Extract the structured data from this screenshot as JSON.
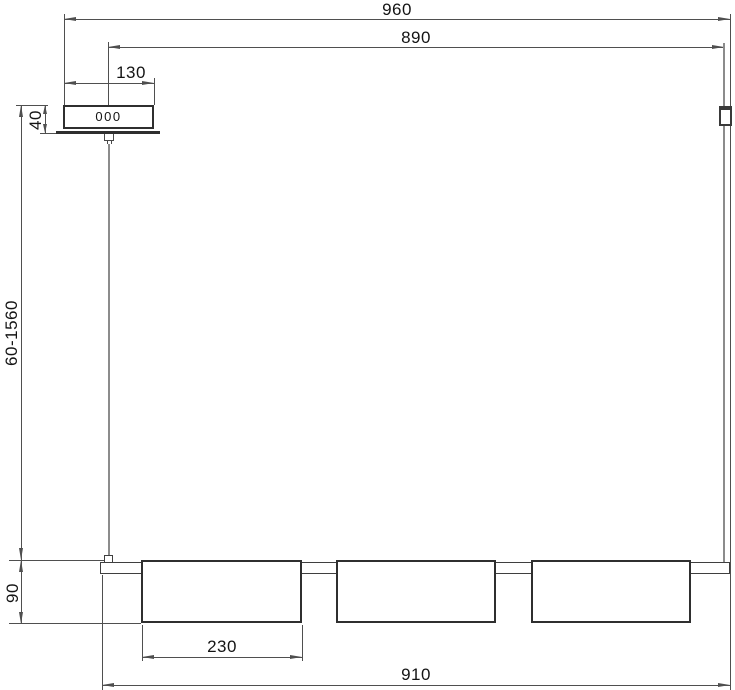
{
  "canopy": {
    "marking": "000"
  },
  "dims": {
    "overall": "960",
    "span": "890",
    "canopy_width": "130",
    "canopy_height": "40",
    "drop": "60-1560",
    "body_height": "90",
    "shade_width": "230",
    "bar_length": "910"
  },
  "colors": {
    "object_line": "#2f2f2f",
    "dimension_line": "#4f4f4f",
    "cable": "#8c8c8c",
    "text": "#141414",
    "background": "#ffffff"
  }
}
